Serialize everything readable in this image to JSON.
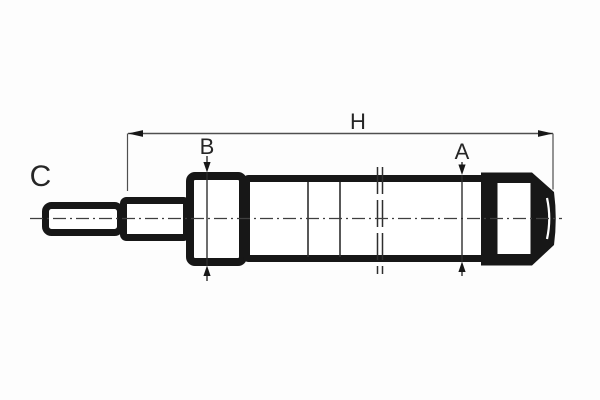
{
  "diagram": {
    "type": "technical-drawing",
    "subject": "shock-absorber side view with dimension callouts",
    "labels": {
      "overall_length": "H",
      "rod_guide_diameter": "B",
      "body_diameter": "A",
      "part_marker": "C"
    },
    "colors": {
      "background": "#fdfdfd",
      "part_outline": "#171717",
      "interior_fill": "#ffffff",
      "dimension_line": "#4f4f4f",
      "thin_line": "#2e2e2e",
      "text": "#262626"
    }
  }
}
